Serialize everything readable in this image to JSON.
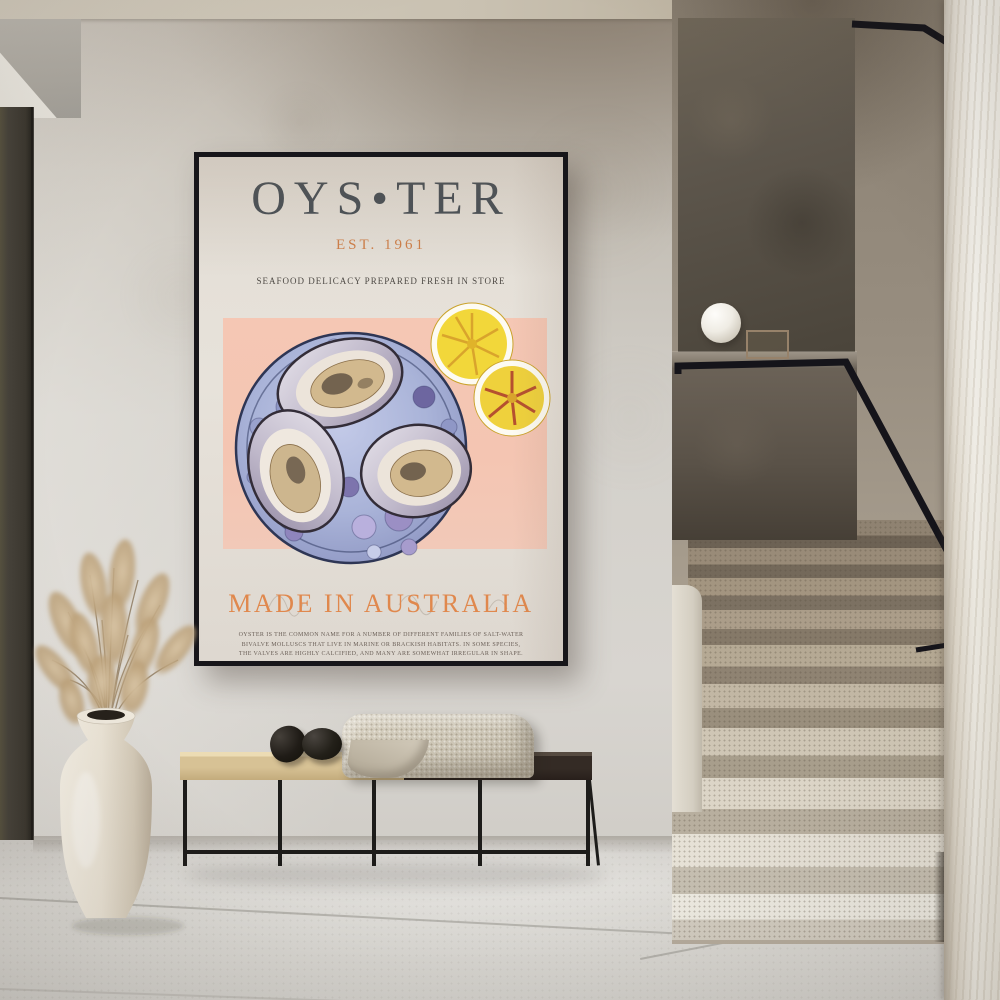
{
  "scene": {
    "description": "Minimalist hallway with a framed oyster art print on a plaster wall, a black metal bench with wood top, woven throw and stone decor, a cream vase with dried pampas grass, and a terrazzo staircase with black handrail and sphere lamp",
    "colors": {
      "wall_plaster": "#d3d0ca",
      "ceiling": "#c9c1b1",
      "floor_tile": "#d8d6d1",
      "stair_dark_wall": "#5d564c",
      "stair_terrazzo_light": "#ece9e0",
      "right_wall_marble": "#efece4",
      "frame_black": "#17161a",
      "bench_wood": "#d7c295",
      "bench_dark_top": "#342b25",
      "vase_cream": "#ece5d8",
      "pampas_tan": "#c4ab8a"
    }
  },
  "poster": {
    "title": "OYS•TER",
    "established": "EST. 1961",
    "subtitle": "SEAFOOD DELICACY PREPARED FRESH IN STORE",
    "tagline": "MADE IN AUSTRALIA",
    "description": "OYSTER IS THE COMMON NAME FOR A NUMBER OF DIFFERENT FAMILIES OF SALT-WATER BIVALVE MOLLUSCS THAT LIVE IN MARINE OR BRACKISH HABITATS. IN SOME SPECIES, THE VALVES ARE HIGHLY CALCIFIED, AND MANY ARE SOMEWHAT IRREGULAR IN SHAPE. MANY, BUT NOT ALL OYSTERS ARE IN THE SUPERFAMILY OSTREOIDEA.",
    "colors": {
      "paper_cream": "#e5e0d8",
      "panel_pink": "#f4c5b2",
      "accent_orange": "#e0884d",
      "title_slate": "#454d54",
      "plate_periwinkle": "#aab4d8",
      "lemon_yellow": "#f2d73a"
    }
  }
}
